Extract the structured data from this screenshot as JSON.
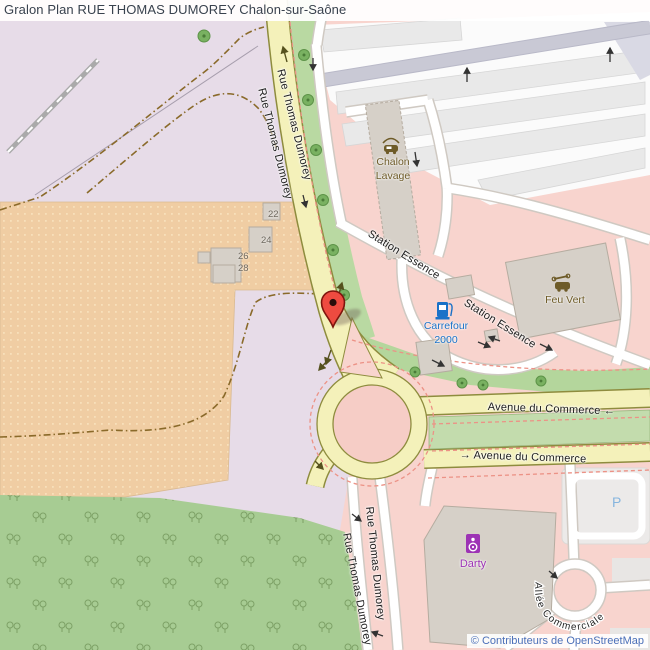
{
  "header": {
    "title": "Gralon Plan RUE THOMAS DUMOREY Chalon-sur-Saône"
  },
  "streets": {
    "rue_thomas_dumorey": "Rue Thomas Dumorey",
    "avenue_du_commerce_west": "Avenue du Commerce ←",
    "avenue_du_commerce_east": "→ Avenue du Commerce",
    "station_essence": "Station Essence",
    "allee_commerciale": "Allée Commerciale"
  },
  "places": {
    "chalon_lavage_line1": "Chalon",
    "chalon_lavage_line2": "Lavage",
    "carrefour_line1": "Carrefour",
    "carrefour_line2": "2000",
    "feu_vert": "Feu Vert",
    "darty": "Darty",
    "parking": "P"
  },
  "house_numbers": [
    "22",
    "24",
    "26",
    "28"
  ],
  "attribution": {
    "text": "© Contributeurs de OpenStreetMap"
  },
  "colors": {
    "residential_pink": "#f8d4ce",
    "industrial_lavender": "#e7dce8",
    "allotments_orange": "#f0cda3",
    "orchard_green": "#a7cc93",
    "road_yellow": "#f4f1ba",
    "road_casing_olive": "#8e8c3e",
    "green_strip": "#b9d9a2",
    "marker_red": "#ee4b40",
    "poi_brown": "#6e5b28",
    "poi_blue": "#1a72c8",
    "poi_purple": "#9d33b5",
    "parking_blue": "#86b5de",
    "attribution_blue": "#4a6fb8",
    "title_color": "#39424e"
  }
}
